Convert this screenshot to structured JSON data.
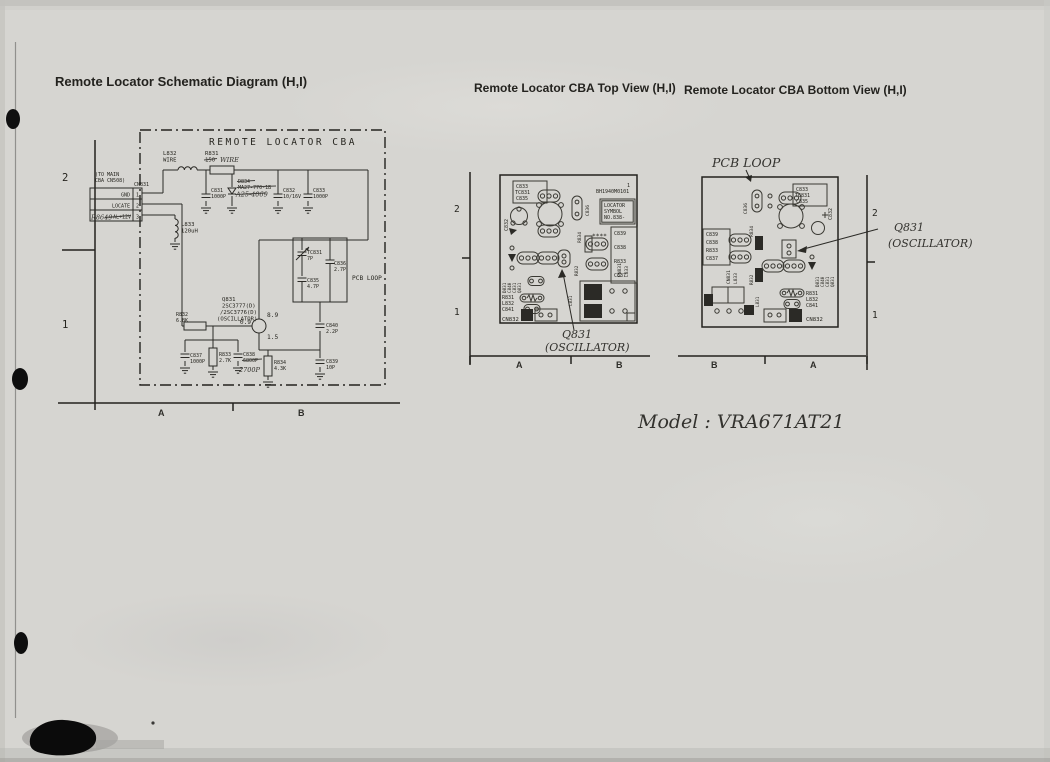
{
  "page": {
    "title_schematic": "Remote Locator Schematic Diagram (H,I)",
    "title_top_view": "Remote Locator CBA Top View (H,I)",
    "title_bottom_view": "Remote Locator CBA Bottom View (H,I)",
    "model_note": "Model : VRA671AT21"
  },
  "schematic": {
    "frame_label": "REMOTE LOCATOR CBA",
    "grid": {
      "row_top": "2",
      "row_bottom": "1",
      "col_left": "A",
      "col_right": "B"
    },
    "connector": {
      "note1": "(TO MAIN",
      "note2": "CBA CN508)",
      "ref": "CN831",
      "pin1_label": "GND",
      "pin1_num": "1",
      "pin2_label": "LOCATE",
      "pin2_num": "2",
      "pin3_label": "AL+12V",
      "pin3_num": "3",
      "pin3_hand": "R8649"
    },
    "l832_ref": "L832",
    "l832_val": "WIRE",
    "r831_ref": "R831",
    "r831_val": "150",
    "r831_hand": "WIRE",
    "c831_ref": "C831",
    "c831_val": "1000P",
    "d834_ref": "D834",
    "d834_val": "MA27-770-1B",
    "d834_hand": "A25-4069",
    "c832_ref": "C832",
    "c832_val": "10/16V",
    "c833_ref": "C833",
    "c833_val": "1000P",
    "l833_ref": "L833",
    "l833_val": "120uH",
    "tc831_ref": "TC831",
    "tc831_val": "7P",
    "c836_ref": "C836",
    "c836_val": "2.7P",
    "c835_ref": "C835",
    "c835_val": "4.7P",
    "loop_label": "PCB LOOP",
    "q831_ref": "Q831",
    "q831_part1": "2SC3777(D)",
    "q831_part2": "/2SC3776(D)",
    "q831_role": "(OSCILLATOR)",
    "q831_vb": "0.9",
    "q831_vc": "8.9",
    "q831_ve": "1.5",
    "r832_ref": "R832",
    "r832_val": "6.8K",
    "c837_ref": "C837",
    "c837_val": "1000P",
    "r833_ref": "R833",
    "r833_val": "2.7K",
    "c838_ref": "C838",
    "c838_val": "6800P",
    "c838_hand": "2700P",
    "r834_ref": "R834",
    "r834_val": "4.3K",
    "c840_ref": "C840",
    "c840_val": "2.2P",
    "c839_ref": "C839",
    "c839_val": "10P"
  },
  "top_view": {
    "grid": {
      "row_top": "2",
      "row_bottom": "1",
      "col_left": "A",
      "col_right": "B"
    },
    "ic_part": "BH1940M0101",
    "ic_mark": "1",
    "locator1": "LOCATOR",
    "locator2": "SYMBOL",
    "locator3": "NO.838-",
    "box_c833": "C833",
    "box_tc831": "TC831",
    "box_c835": "C835",
    "c832": "C832",
    "c836": "C836",
    "r834": "R834",
    "stars": "****",
    "col_c839": "C839",
    "col_c838": "C838",
    "col_r833": "R833",
    "col_c837": "C837",
    "vert_d831": "D831",
    "vert_c840": "C840",
    "vert_c831": "C831",
    "vert_q831": "Q831",
    "r831": "R831",
    "l832": "L832",
    "c841": "C841",
    "cn832": "CN832",
    "cn831": "CN831",
    "l833": "L833",
    "l831": "L831",
    "r832": "R832",
    "hand_q831": "Q831",
    "hand_osc": "(OSCILLATOR)"
  },
  "bottom_view": {
    "grid": {
      "row_top": "2",
      "row_bottom": "1",
      "col_left": "B",
      "col_right": "A"
    },
    "hand_pcb_loop": "PCB  LOOP",
    "box_c833": "C833",
    "box_tc831": "TC831",
    "box_c835": "C835",
    "c832": "C832",
    "c836": "C836",
    "r834": "R834",
    "col_c839": "C839",
    "col_c838": "C838",
    "col_r833": "R833",
    "col_c837": "C837",
    "vert_d831": "D831",
    "vert_c840": "C840",
    "vert_c831": "C831",
    "vert_q831": "Q831",
    "r831": "R831",
    "l832": "L832",
    "c841": "C841",
    "cn832": "CN832",
    "cn831": "CN831",
    "l833": "L833",
    "l831": "L831",
    "r832": "R832",
    "hand_q831": "Q831",
    "hand_osc": "(OSCILLATOR)"
  }
}
